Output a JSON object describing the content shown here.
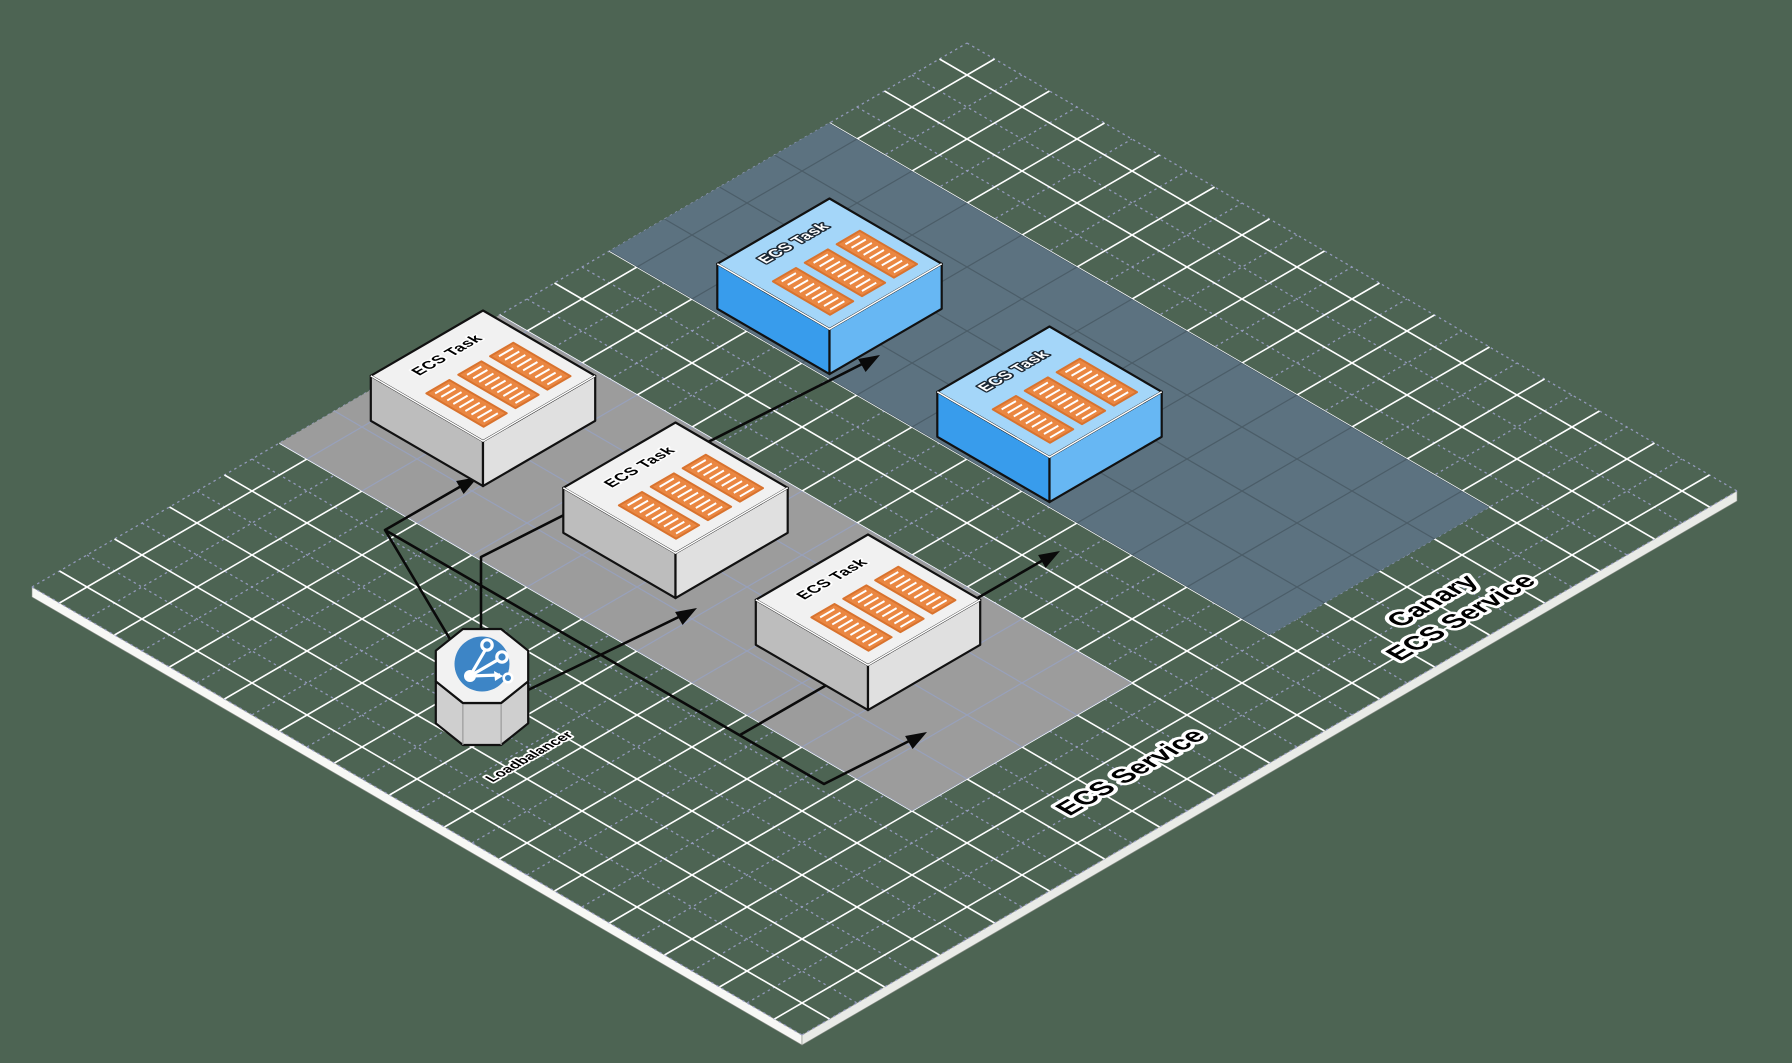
{
  "diagram": {
    "type": "isometric-architecture",
    "colors": {
      "background": "#4d6453",
      "grid_major": "#ffffff",
      "grid_minor": "#9fa3cc",
      "ecs_band": "#9c9c9c",
      "ecs_band_grid": "#98a1bb",
      "canary_band": "#5c7280",
      "canary_band_grid": "#4b5d68",
      "task_top": "#f1f1f1",
      "task_left": "#bdbdbd",
      "task_right": "#e0e0e0",
      "canary_task_top": "#a4d6f9",
      "canary_task_left": "#389cec",
      "canary_task_right": "#67b7f3",
      "container": "#ea8742",
      "container_border": "#d9732e",
      "arrow": "#0a0a0a",
      "loadbalancer_circle": "#3d85c6",
      "outline": "#111111"
    },
    "loadbalancer": {
      "label": "Loadbalancer",
      "icon": "share-network-icon",
      "u": 2.4,
      "v": 5.8
    },
    "services": [
      {
        "id": "ecs-service",
        "label": "ECS Service",
        "band": {
          "u1": 4.5,
          "u2": 8.5,
          "v1": 0,
          "v2": 11.5
        },
        "tasks": [
          {
            "label": "ECS Task",
            "u": 7.4,
            "v": 0.8
          },
          {
            "label": "ECS Task",
            "u": 7.4,
            "v": 4.3
          },
          {
            "label": "ECS Task",
            "u": 7.4,
            "v": 7.8
          }
        ]
      },
      {
        "id": "canary-ecs-service",
        "label": "Canary ECS Service",
        "label_lines": [
          "Canary",
          "ECS Service"
        ],
        "band": {
          "u1": 10.5,
          "u2": 14.5,
          "v1": 0,
          "v2": 12
        },
        "tasks": [
          {
            "label": "ECS Task",
            "u": 12.3,
            "v": 2.2
          },
          {
            "label": "ECS Task",
            "u": 12.3,
            "v": 6.2
          }
        ]
      }
    ],
    "edges": [
      {
        "from": "loadbalancer",
        "to": "ecs-service task 1"
      },
      {
        "from": "loadbalancer",
        "to": "ecs-service task 2"
      },
      {
        "from": "loadbalancer",
        "to": "ecs-service task 3"
      },
      {
        "from": "loadbalancer",
        "to": "canary-ecs-service task 1"
      },
      {
        "from": "loadbalancer",
        "to": "canary-ecs-service task 2"
      }
    ]
  }
}
